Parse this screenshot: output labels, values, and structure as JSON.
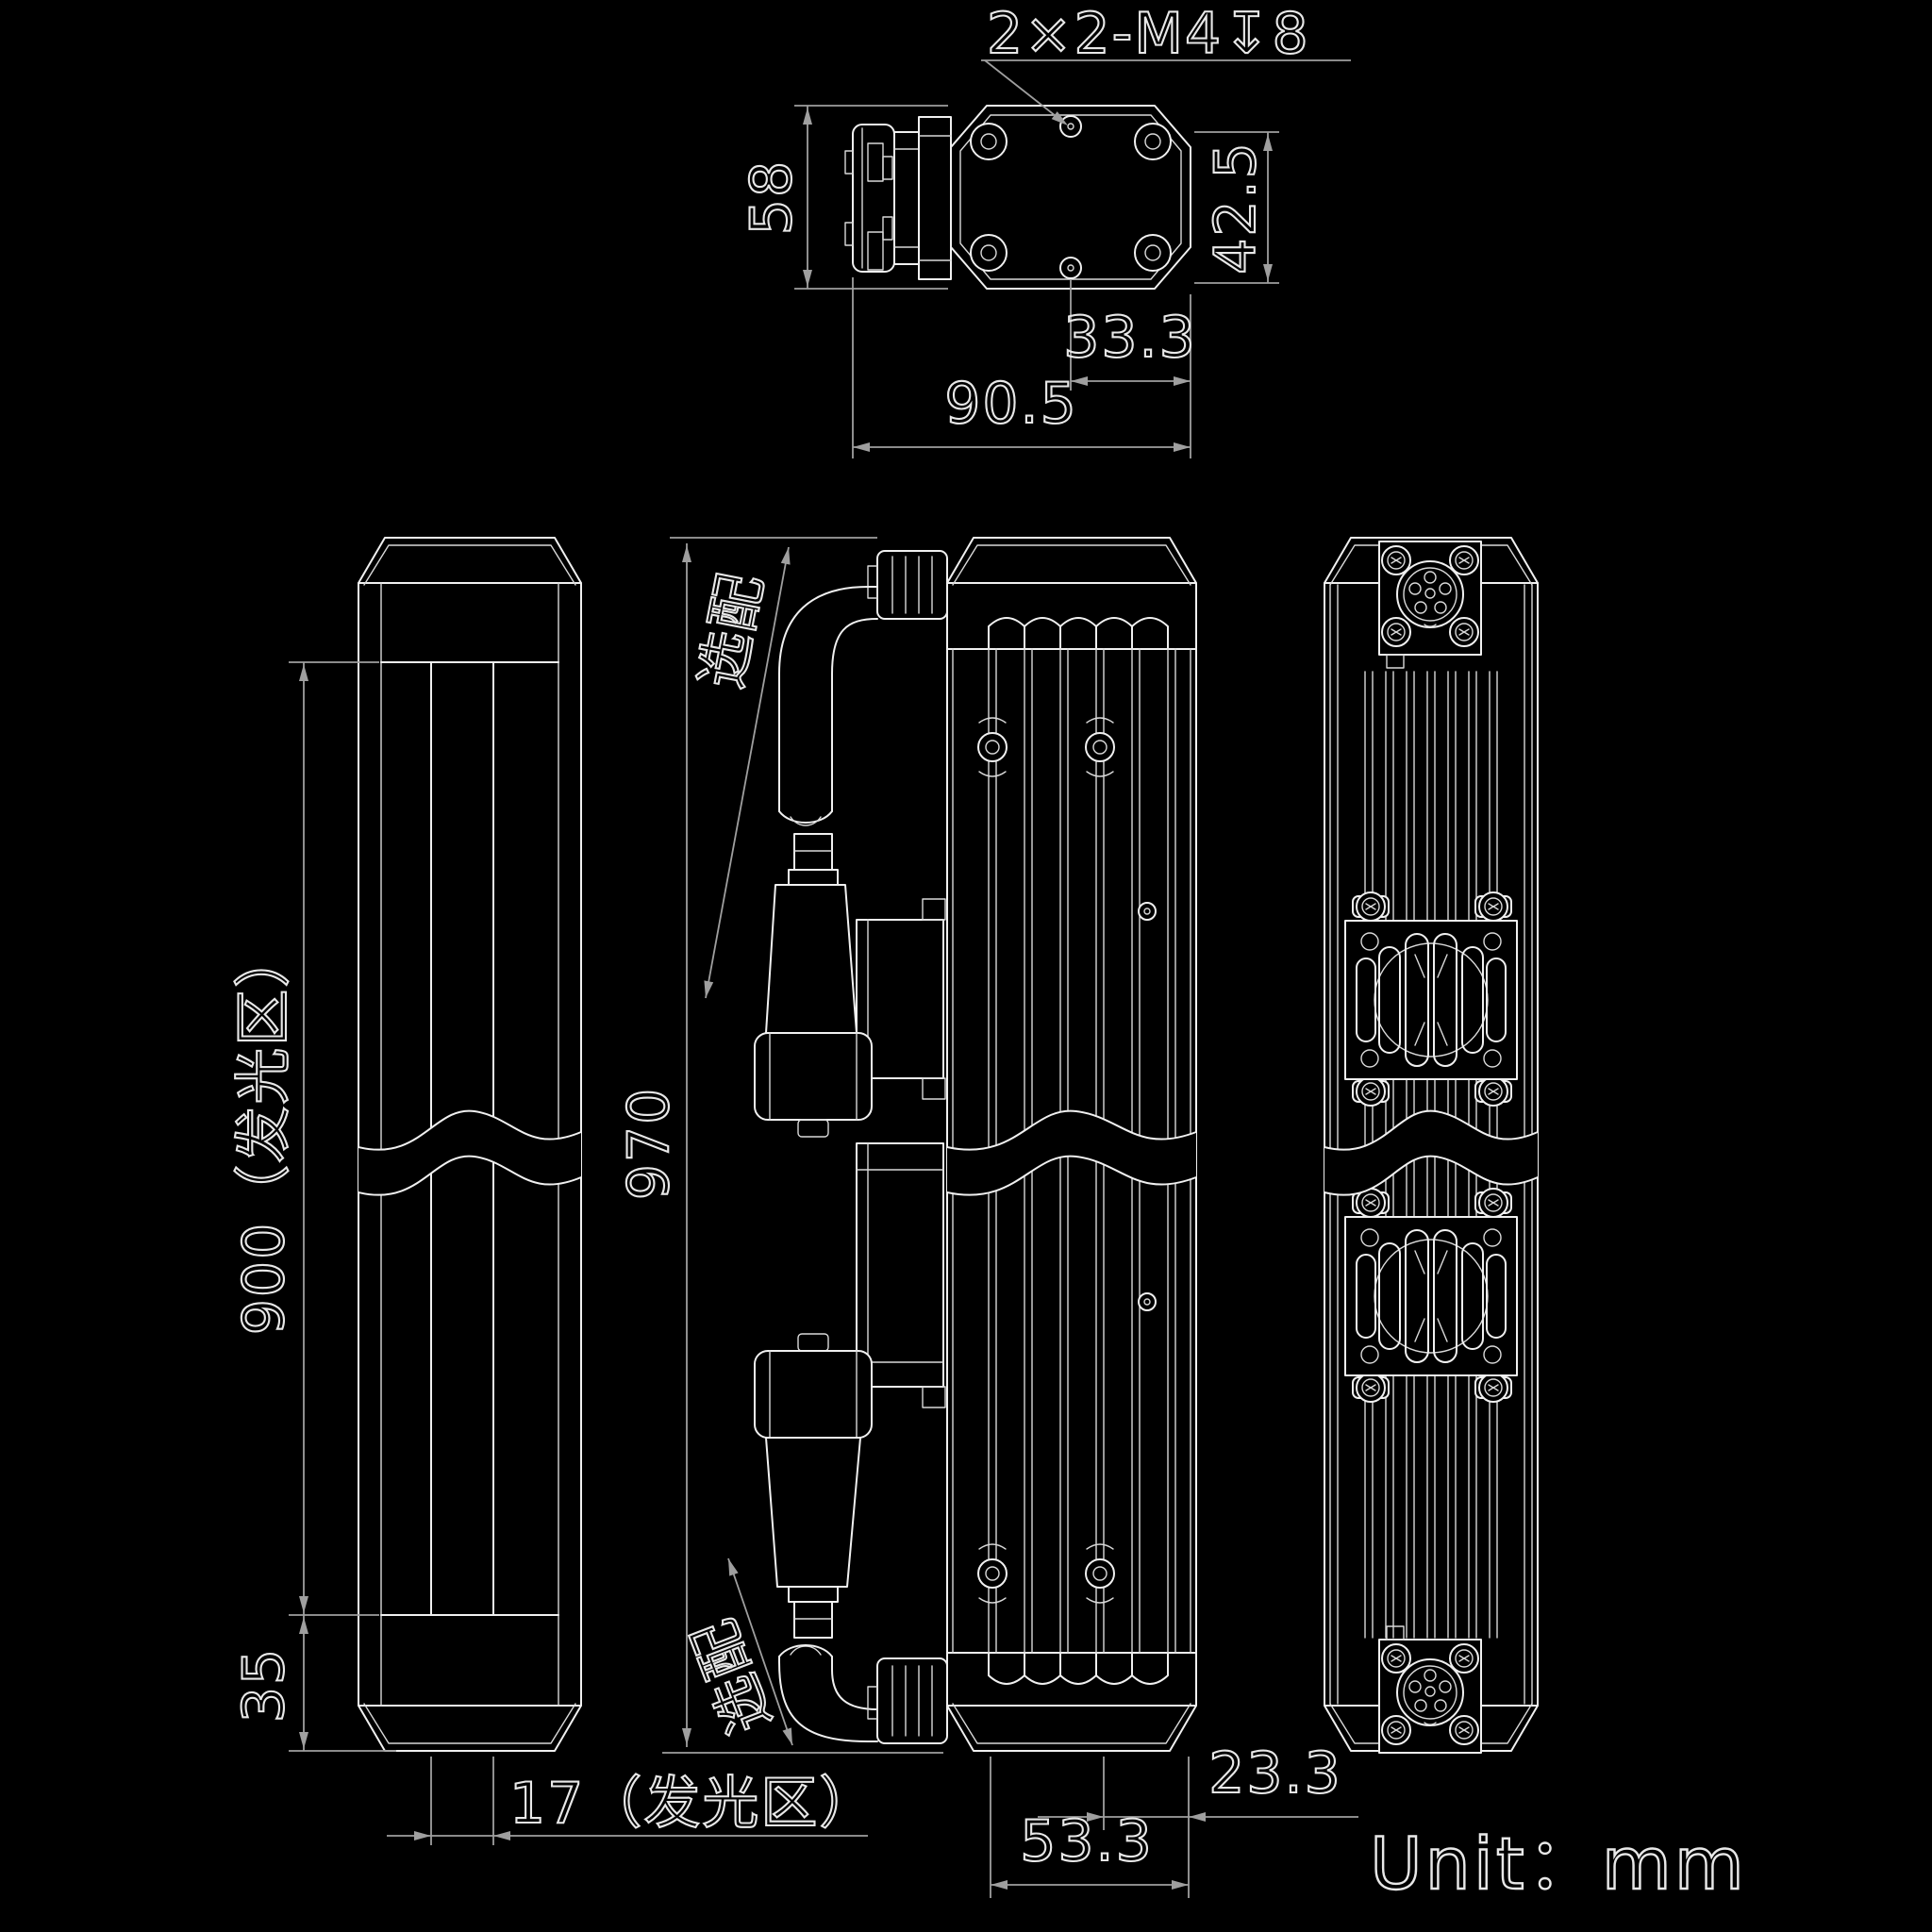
{
  "colors": {
    "background": "#000000",
    "geometry_line": "#f0f0f0",
    "dimension_line": "#9f9f9f",
    "dimension_text": "#e8e8e8"
  },
  "unit_label": "Unit：mm",
  "views": {
    "top": {
      "thread_callout": "2×2-M4↧8",
      "height": "58",
      "screw_span_vertical": "42.5",
      "hole_to_edge": "33.3",
      "width": "90.5"
    },
    "front": {
      "emitting_length": "900（发光区）",
      "bottom_offset": "35",
      "emitting_width": "17（发光区）"
    },
    "side": {
      "overall_length": "970",
      "optional_top": "选配",
      "optional_bottom": "选配"
    },
    "back": {
      "edge_to_screw": "23.3",
      "screw_span": "53.3"
    }
  }
}
